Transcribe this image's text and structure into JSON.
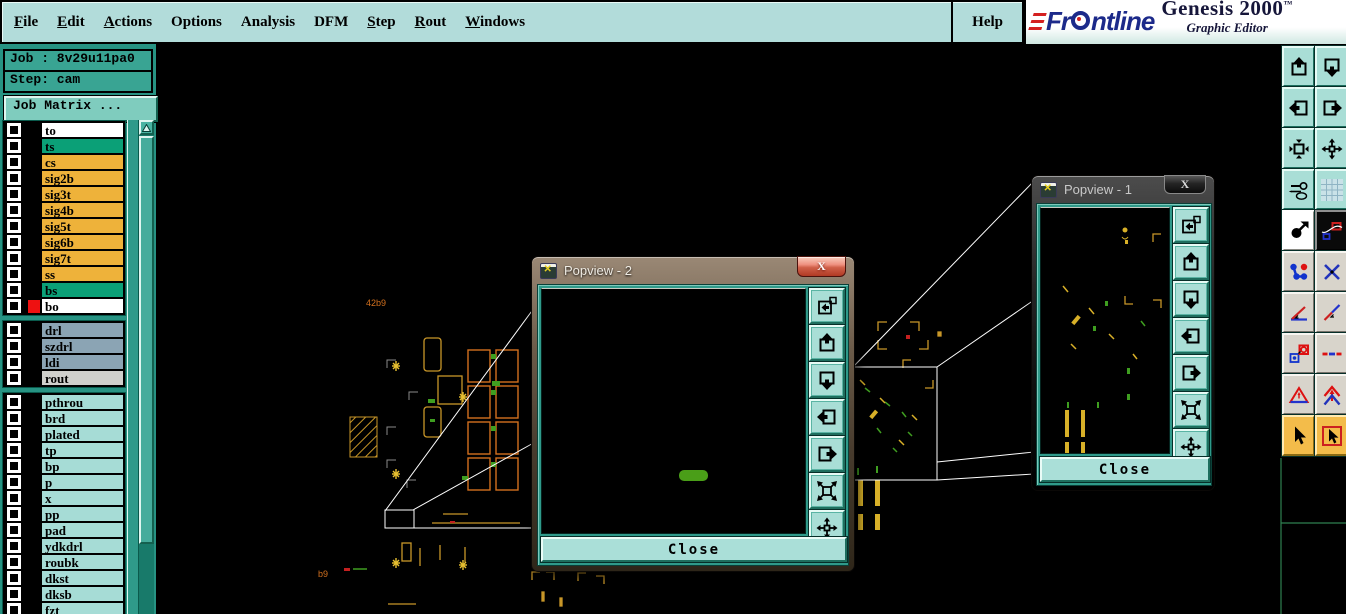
{
  "app": {
    "brand": "Frontline",
    "product": "Genesis 2000",
    "trademark": "™",
    "subtitle": "Graphic Editor"
  },
  "menu": {
    "items": [
      {
        "label": "File",
        "underline": 0
      },
      {
        "label": "Edit",
        "underline": 0
      },
      {
        "label": "Actions",
        "underline": 0
      },
      {
        "label": "Options",
        "underline": -1
      },
      {
        "label": "Analysis",
        "underline": -1
      },
      {
        "label": "DFM",
        "underline": -1
      },
      {
        "label": "Step",
        "underline": 0
      },
      {
        "label": "Rout",
        "underline": 0
      },
      {
        "label": "Windows",
        "underline": 0
      }
    ],
    "help_label": "Help"
  },
  "job_panel": {
    "job_text": "Job : 8v29u11pa0",
    "step_text": "Step: cam",
    "matrix_button_label": "Job Matrix ..."
  },
  "layer_list": {
    "groups": [
      {
        "rows": [
          {
            "name": "to",
            "bg": "#ffffff"
          },
          {
            "name": "ts",
            "bg": "#0ba077"
          },
          {
            "name": "cs",
            "bg": "#eeb23a"
          },
          {
            "name": "sig2b",
            "bg": "#eeb23a"
          },
          {
            "name": "sig3t",
            "bg": "#eeb23a"
          },
          {
            "name": "sig4b",
            "bg": "#eeb23a"
          },
          {
            "name": "sig5t",
            "bg": "#eeb23a"
          },
          {
            "name": "sig6b",
            "bg": "#eeb23a"
          },
          {
            "name": "sig7t",
            "bg": "#eeb23a"
          },
          {
            "name": "ss",
            "bg": "#eeb23a"
          },
          {
            "name": "bs",
            "bg": "#0ba077"
          },
          {
            "name": "bo",
            "bg": "#ffffff",
            "swatch": "#ee1111"
          }
        ]
      },
      {
        "rows": [
          {
            "name": "drl",
            "bg": "#8ba4b4"
          },
          {
            "name": "szdrl",
            "bg": "#8ba4b4"
          },
          {
            "name": "ldi",
            "bg": "#8ba4b4"
          },
          {
            "name": "rout",
            "bg": "#d0d0cc"
          }
        ]
      },
      {
        "rows": [
          {
            "name": "pthrou",
            "bg": "#a6dcd6"
          },
          {
            "name": "brd",
            "bg": "#a6dcd6"
          },
          {
            "name": "plated",
            "bg": "#a6dcd6"
          },
          {
            "name": "tp",
            "bg": "#a6dcd6"
          },
          {
            "name": "bp",
            "bg": "#a6dcd6"
          },
          {
            "name": "p",
            "bg": "#a6dcd6"
          },
          {
            "name": "x",
            "bg": "#a6dcd6"
          },
          {
            "name": "pp",
            "bg": "#a6dcd6"
          },
          {
            "name": "pad",
            "bg": "#a6dcd6"
          },
          {
            "name": "ydkdrl",
            "bg": "#a6dcd6"
          },
          {
            "name": "roubk",
            "bg": "#a6dcd6"
          },
          {
            "name": "dkst",
            "bg": "#a6dcd6"
          },
          {
            "name": "dksb",
            "bg": "#a6dcd6"
          },
          {
            "name": "fzt",
            "bg": "#a6dcd6"
          }
        ]
      }
    ]
  },
  "popviews": {
    "popview2": {
      "title": "Popview - 2",
      "close_label": "Close"
    },
    "popview1": {
      "title": "Popview - 1",
      "close_label": "Close"
    },
    "side_buttons": [
      "new-popview-icon",
      "pan-up-icon",
      "pan-down-icon",
      "pan-left-icon",
      "pan-right-icon",
      "zoom-out-icon",
      "zoom-center-icon"
    ]
  },
  "toolbar": {
    "buttons": [
      {
        "icon": "pan-up-icon",
        "style": "teal"
      },
      {
        "icon": "pan-down-icon",
        "style": "teal"
      },
      {
        "icon": "pan-left-icon",
        "style": "teal"
      },
      {
        "icon": "pan-right-icon",
        "style": "teal"
      },
      {
        "icon": "zoom-fit-icon",
        "style": "teal"
      },
      {
        "icon": "zoom-center-icon",
        "style": "teal"
      },
      {
        "icon": "setup-tools-icon",
        "style": "teal"
      },
      {
        "icon": "grid-icon",
        "style": "teal"
      },
      {
        "icon": "move-object-icon",
        "style": "white"
      },
      {
        "icon": "graphic-shapes-icon",
        "style": "black"
      },
      {
        "icon": "netlist-icon",
        "style": "gray"
      },
      {
        "icon": "delete-cross-icon",
        "style": "gray"
      },
      {
        "icon": "measure-angle-icon",
        "style": "gray"
      },
      {
        "icon": "measure-distance-icon",
        "style": "gray"
      },
      {
        "icon": "copy-pad-icon",
        "style": "gray"
      },
      {
        "icon": "dashed-line-icon",
        "style": "gray"
      },
      {
        "icon": "triangle-marker-icon",
        "style": "gray"
      },
      {
        "icon": "arrow-marker-icon",
        "style": "gray"
      },
      {
        "icon": "select-cursor-icon",
        "style": "orange"
      },
      {
        "icon": "select-area-icon",
        "style": "orange"
      }
    ]
  },
  "canvas": {
    "label_top": "42b9",
    "label_bottom": "b9"
  },
  "colors": {
    "menubar_bg": "#b2dcda",
    "panel_bg": "#279383",
    "canvas_gold": "#c89628",
    "canvas_orange": "#d2701e",
    "canvas_green": "#3f9e20",
    "popview_face": "#2f9a8a",
    "close_face": "#aadfd8",
    "highlight_green": "#4a9e18",
    "layer_red": "#ee1111"
  }
}
